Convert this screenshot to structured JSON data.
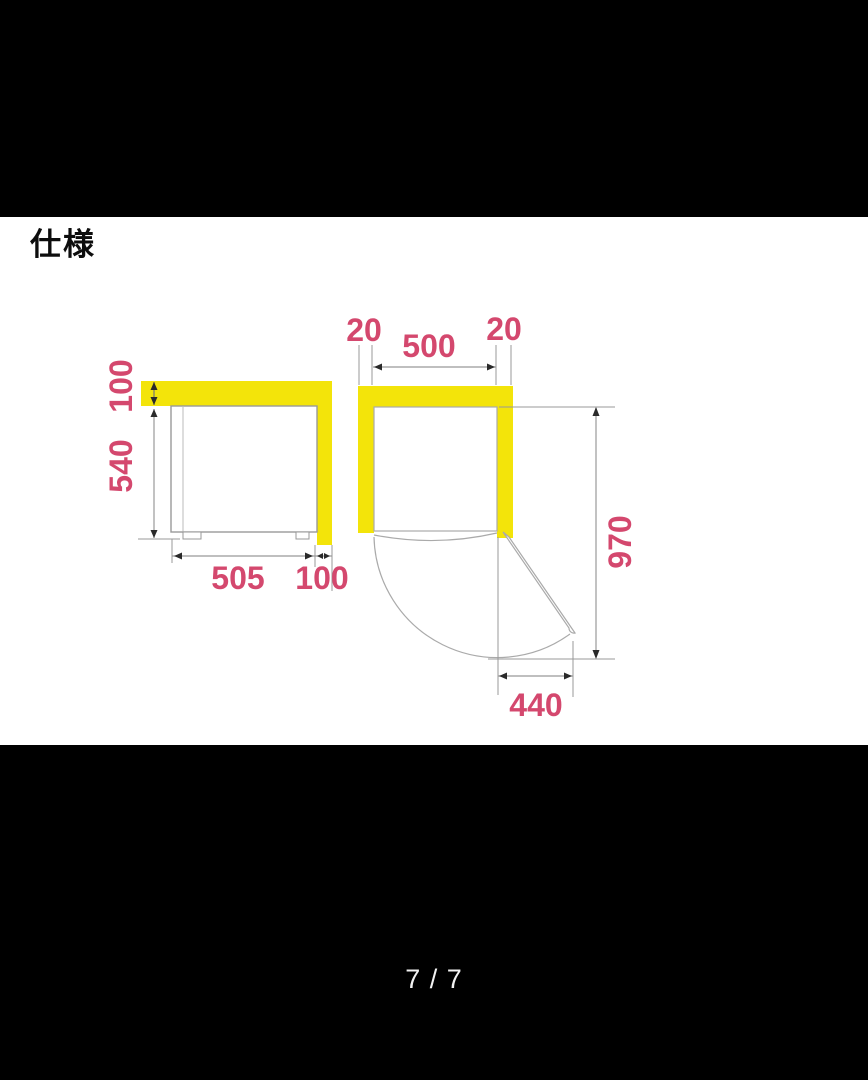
{
  "image_viewer": {
    "page_indicator": "7 / 7"
  },
  "spec_sheet": {
    "heading": "仕様",
    "side_view": {
      "top_clearance_label": "100",
      "body_height_label": "540",
      "body_depth_label": "505",
      "rear_clearance_label": "100"
    },
    "top_view": {
      "left_clearance_label": "20",
      "body_width_label": "500",
      "right_clearance_label": "20",
      "depth_door_open_label": "970",
      "door_swing_label": "440"
    }
  },
  "colors": {
    "background": "#000000",
    "panel": "#ffffff",
    "clearance_highlight_yellow": "#f3e40a",
    "dimension_text_pink": "#d4486e",
    "drawing_line_gray": "#9a9a9a",
    "arrow_dark": "#2a2a2a"
  }
}
